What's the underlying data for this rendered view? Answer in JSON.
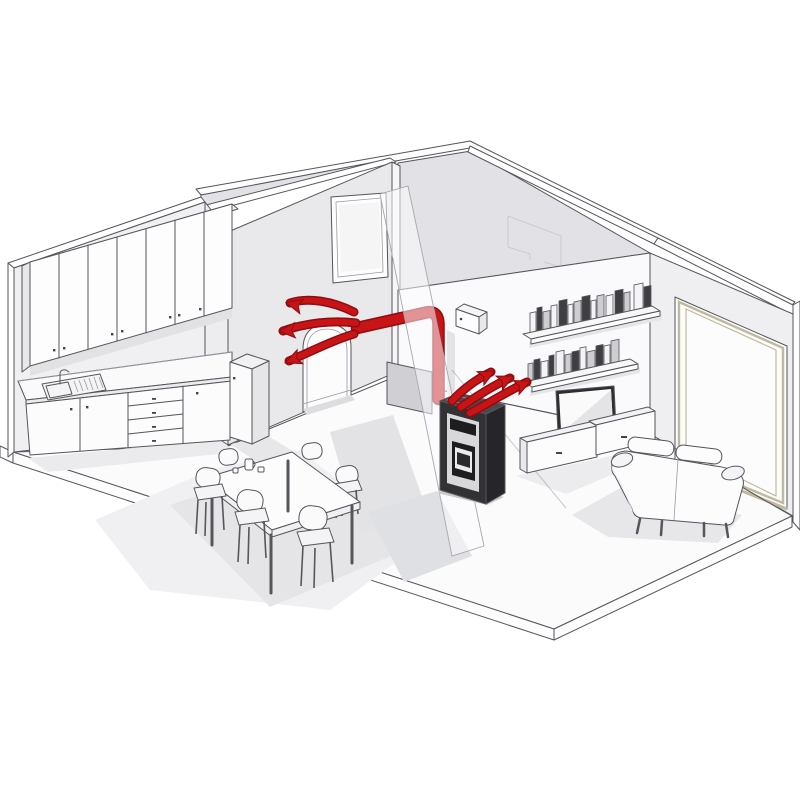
{
  "meta": {
    "title": "Isometric cutaway illustration of an apartment with a ducted pellet stove distributing warm air",
    "canvas": {
      "width": 800,
      "height": 800
    }
  },
  "colors": {
    "outline": "#55555b",
    "background": "#ffffff",
    "ceiling": "#fdfdfe",
    "wallKitchen": "#f0f0f2",
    "wallArch": "#e9e9eb",
    "wallUpperShade": "#e2e2e6",
    "wallLiving": "#fafafc",
    "wallRight": "#efeff1",
    "floor": "#fbfbfc",
    "slab": "#fdfdfe",
    "shadowSoft": "#f0f0f2",
    "shadowMid": "#e5e5e8",
    "shadowDeep": "#d8d8dc",
    "red": "#c81317",
    "redDark": "#8f0c10",
    "tan": "#bfb99d",
    "stoveFront": "#323235",
    "stoveSide": "#26262a",
    "stoveTop": "#4a4a4e",
    "stovePanel": "#d8d8db",
    "stoveDark": "#1d1d20",
    "glassLight": "#ebebee",
    "grayPanel": "#cfcfd4",
    "furnitureWhite": "#fcfcfd",
    "tvFrame": "#2e2e31",
    "screen": "#fafafb",
    "bookLight": "#f4f4f6",
    "bookGray": "#cdced2",
    "bookDark": "#3e3e43"
  },
  "objects": {
    "rooms": [
      "kitchen",
      "dining area",
      "living room"
    ],
    "architecture": [
      "arched doorway wall",
      "framed window on interior wall",
      "large glazed window wall",
      "cutaway ceiling",
      "floor slab"
    ],
    "furniture": [
      "upper kitchen cabinets with 7 doors",
      "kitchen counter with sink, doors and 4 drawers",
      "tall kitchen cabinet",
      "dining table",
      "6 dining chairs",
      "2 wall shelves with books",
      "flat screen TV",
      "2 media cabinets",
      "two-seat sofa"
    ],
    "heating_system": [
      "pellet stove",
      "red warm-air duct with elbow",
      "wall duct outlet",
      "vent box",
      "3 airflow arrows into kitchen",
      "3 airflow arrows toward living room shelf"
    ]
  },
  "shelves": {
    "skew": 0.22,
    "upper_books": [
      {
        "x": 530,
        "y": 334,
        "w": 6,
        "h": 21,
        "c": "bookLight"
      },
      {
        "x": 537,
        "y": 332,
        "w": 5,
        "h": 24,
        "c": "bookDark"
      },
      {
        "x": 543,
        "y": 331,
        "w": 7,
        "h": 19,
        "c": "bookGray"
      },
      {
        "x": 551,
        "y": 329,
        "w": 6,
        "h": 23,
        "c": "bookLight"
      },
      {
        "x": 559,
        "y": 327,
        "w": 8,
        "h": 26,
        "c": "bookDark"
      },
      {
        "x": 568,
        "y": 325,
        "w": 5,
        "h": 20,
        "c": "bookLight"
      },
      {
        "x": 574,
        "y": 324,
        "w": 7,
        "h": 22,
        "c": "bookGray"
      },
      {
        "x": 582,
        "y": 322,
        "w": 8,
        "h": 25,
        "c": "bookDark"
      },
      {
        "x": 591,
        "y": 320,
        "w": 5,
        "h": 19,
        "c": "bookLight"
      },
      {
        "x": 597,
        "y": 319,
        "w": 7,
        "h": 23,
        "c": "bookGray"
      },
      {
        "x": 606,
        "y": 317,
        "w": 7,
        "h": 21,
        "c": "bookLight"
      },
      {
        "x": 615,
        "y": 315,
        "w": 8,
        "h": 24,
        "c": "bookDark"
      },
      {
        "x": 624,
        "y": 313,
        "w": 6,
        "h": 20,
        "c": "bookGray"
      },
      {
        "x": 634,
        "y": 311,
        "w": 9,
        "h": 26,
        "c": "bookLight"
      },
      {
        "x": 644,
        "y": 309,
        "w": 7,
        "h": 22,
        "c": "bookDark"
      }
    ],
    "lower_books": [
      {
        "x": 528,
        "y": 381,
        "w": 5,
        "h": 17,
        "c": "bookGray"
      },
      {
        "x": 534,
        "y": 380,
        "w": 6,
        "h": 20,
        "c": "bookDark"
      },
      {
        "x": 541,
        "y": 378,
        "w": 7,
        "h": 16,
        "c": "bookLight"
      },
      {
        "x": 549,
        "y": 377,
        "w": 5,
        "h": 21,
        "c": "bookDark"
      },
      {
        "x": 556,
        "y": 375,
        "w": 8,
        "h": 23,
        "c": "bookLight"
      },
      {
        "x": 565,
        "y": 373,
        "w": 6,
        "h": 18,
        "c": "bookGray"
      },
      {
        "x": 572,
        "y": 372,
        "w": 7,
        "h": 20,
        "c": "bookDark"
      },
      {
        "x": 580,
        "y": 370,
        "w": 6,
        "h": 22,
        "c": "bookLight"
      },
      {
        "x": 587,
        "y": 369,
        "w": 8,
        "h": 17,
        "c": "bookGray"
      },
      {
        "x": 596,
        "y": 367,
        "w": 7,
        "h": 21,
        "c": "bookDark"
      },
      {
        "x": 604,
        "y": 365,
        "w": 6,
        "h": 19,
        "c": "bookLight"
      },
      {
        "x": 611,
        "y": 364,
        "w": 8,
        "h": 23,
        "c": "bookGray"
      }
    ]
  },
  "airflow": {
    "left_arrows": [
      {
        "d": "M 354 312 C 332 301, 308 297, 290 303",
        "tip": [
          288,
          303
        ],
        "angle": 194
      },
      {
        "d": "M 356 323 C 332 320, 306 323, 283 331",
        "tip": [
          281,
          331
        ],
        "angle": 177
      },
      {
        "d": "M 354 334 C 334 340, 312 351, 289 361",
        "tip": [
          287,
          362
        ],
        "angle": 158
      }
    ],
    "right_arrows": [
      {
        "d": "M 452 401 C 464 388, 477 379, 491 372",
        "tip": [
          493,
          372
        ],
        "angle": -27
      },
      {
        "d": "M 461 407 C 477 396, 494 385, 510 378",
        "tip": [
          512,
          377
        ],
        "angle": -25
      },
      {
        "d": "M 470 413 C 489 403, 508 391, 527 382",
        "tip": [
          529,
          382
        ],
        "angle": -23
      }
    ]
  }
}
